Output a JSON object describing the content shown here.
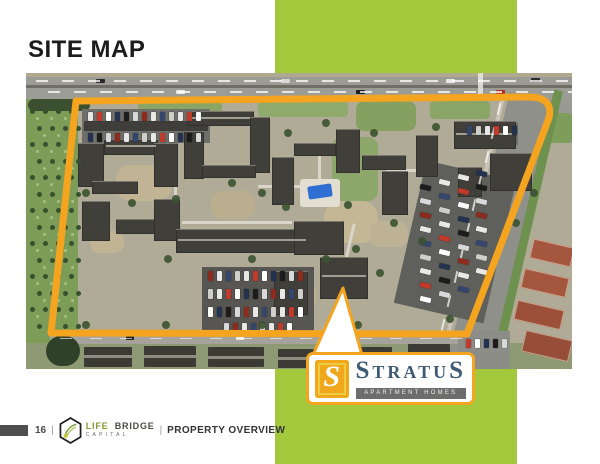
{
  "slide": {
    "title": "SITE MAP",
    "accent_green": "#a3c83c",
    "accent_orange": "#f4a41f"
  },
  "footer": {
    "page_number": "16",
    "divider": "|",
    "brand_word1": "LIFE",
    "brand_word2": "BRIDGE",
    "brand_sub": "CAPITAL",
    "section": "PROPERTY OVERVIEW"
  },
  "logo": {
    "tile_letter": "S",
    "name_first": "S",
    "name_mid": "TRATU",
    "name_last": "S",
    "subtitle": "APARTMENT HOMES",
    "name_color": "#3e5a74",
    "bar_color": "#6d6d6d",
    "tile_color": "#f0a71c"
  },
  "callout": {
    "tail_points": "43,8 62,75 13,75"
  },
  "map": {
    "boundary_path": "M50 28 L500 24 Q528 23 523 45 L441 261 L25 260 Z",
    "boundary_color": "#f4a41f",
    "car_palette": [
      "#e8e8e6",
      "#c23a2c",
      "#ffffff",
      "#23324f",
      "#1c1c1c",
      "#d6d8da",
      "#8e2b1f",
      "#e8e8e6",
      "#34466e",
      "#cfcfca"
    ],
    "rects": [
      {
        "x": 0,
        "y": 0,
        "w": 546,
        "h": 26,
        "c": "#9c9c97"
      },
      {
        "x": 0,
        "y": 0,
        "w": 546,
        "h": 4,
        "c": "#b0a88f"
      },
      {
        "x": 0,
        "y": 12,
        "w": 546,
        "h": 2.5,
        "c": "#6f6d66"
      },
      {
        "x": 452,
        "y": 0,
        "w": 5,
        "h": 26,
        "c": "#e6e6e2",
        "o": 0.85
      },
      {
        "x": 70,
        "y": 6,
        "w": 9,
        "h": 4,
        "c": "#2a2a2a",
        "br": 1
      },
      {
        "x": 150,
        "y": 17,
        "w": 9,
        "h": 4,
        "c": "#e8e8e6",
        "br": 1
      },
      {
        "x": 255,
        "y": 6,
        "w": 9,
        "h": 4,
        "c": "#d8d8d4",
        "br": 1
      },
      {
        "x": 330,
        "y": 17,
        "w": 9,
        "h": 4,
        "c": "#1f1f1f",
        "br": 1
      },
      {
        "x": 420,
        "y": 6,
        "w": 9,
        "h": 4,
        "c": "#e8e8e6",
        "br": 1
      },
      {
        "x": 470,
        "y": 17,
        "w": 9,
        "h": 4,
        "c": "#b02c20",
        "br": 1
      },
      {
        "x": 505,
        "y": 5,
        "w": 9,
        "h": 4,
        "c": "#2a2a2a",
        "br": 1
      },
      {
        "x": 0,
        "y": 26,
        "w": 52,
        "h": 244,
        "c": "#7d9c58"
      },
      {
        "x": 2,
        "y": 26,
        "w": 62,
        "h": 12,
        "c": "#3c4f30",
        "br": 6
      },
      {
        "x": 0,
        "y": 270,
        "w": 546,
        "h": 26,
        "c": "#8e9a74"
      },
      {
        "x": 508,
        "y": 26,
        "w": 38,
        "h": 44,
        "c": "#9a9a94"
      },
      {
        "x": 522,
        "y": 40,
        "w": 24,
        "h": 30,
        "c": "#7e9c5a",
        "br": 4
      },
      {
        "x": 452,
        "y": 20,
        "w": 44,
        "h": 276,
        "c": "#90908b",
        "rot": 13
      },
      {
        "x": 497,
        "y": 14,
        "w": 9,
        "h": 276,
        "c": "#6f9150",
        "rot": 13
      },
      {
        "x": 444,
        "y": 24,
        "w": 4,
        "h": 268,
        "c": "#cfccc0",
        "o": 0.8,
        "rot": 13
      },
      {
        "x": 112,
        "y": 28,
        "w": 84,
        "h": 14,
        "c": "#8ba566",
        "br": 4
      },
      {
        "x": 232,
        "y": 28,
        "w": 90,
        "h": 16,
        "c": "#90a96c",
        "br": 4
      },
      {
        "x": 330,
        "y": 28,
        "w": 60,
        "h": 30,
        "c": "#85a060",
        "br": 8
      },
      {
        "x": 404,
        "y": 28,
        "w": 60,
        "h": 18,
        "c": "#8ba566",
        "br": 4
      },
      {
        "x": 306,
        "y": 64,
        "w": 46,
        "h": 64,
        "c": "#8da66a",
        "br": 10
      },
      {
        "x": 90,
        "y": 92,
        "w": 56,
        "h": 36,
        "c": "#c0b494",
        "br": 14
      },
      {
        "x": 185,
        "y": 118,
        "w": 44,
        "h": 28,
        "c": "#bbae8e",
        "br": 12
      },
      {
        "x": 298,
        "y": 128,
        "w": 54,
        "h": 42,
        "c": "#c3b795",
        "br": 16
      },
      {
        "x": 246,
        "y": 208,
        "w": 44,
        "h": 32,
        "c": "#bdb192",
        "br": 12
      },
      {
        "x": 64,
        "y": 158,
        "w": 34,
        "h": 22,
        "c": "#c0b494",
        "br": 10
      },
      {
        "x": 344,
        "y": 148,
        "w": 38,
        "h": 26,
        "c": "#beb294",
        "br": 10
      },
      {
        "x": 148,
        "y": 60,
        "w": 3,
        "h": 70,
        "c": "#d9d5c8"
      },
      {
        "x": 232,
        "y": 112,
        "w": 60,
        "h": 3,
        "c": "#d9d5c8"
      },
      {
        "x": 292,
        "y": 76,
        "w": 3,
        "h": 54,
        "c": "#d9d5c8"
      },
      {
        "x": 156,
        "y": 148,
        "w": 110,
        "h": 3,
        "c": "#d9d5c8"
      },
      {
        "x": 320,
        "y": 150,
        "w": 3,
        "h": 60,
        "c": "#d9d5c8",
        "rot": 13
      },
      {
        "x": 360,
        "y": 96,
        "w": 40,
        "h": 3,
        "c": "#d9d5c8"
      },
      {
        "x": 56,
        "y": 36,
        "w": 128,
        "h": 34,
        "c": "#6e6e6a"
      },
      {
        "x": 58,
        "y": 48,
        "w": 124,
        "h": 10,
        "c": "#3f3e3a"
      },
      {
        "x": 176,
        "y": 194,
        "w": 112,
        "h": 66,
        "c": "#575652"
      },
      {
        "x": 383,
        "y": 96,
        "w": 92,
        "h": 146,
        "c": "#5f5f5b",
        "rot": 13
      },
      {
        "x": 438,
        "y": 50,
        "w": 54,
        "h": 22,
        "c": "#6e6e6a"
      },
      {
        "x": 52,
        "y": 70,
        "w": 26,
        "h": 44,
        "c": "#403f3a",
        "cls": "bld"
      },
      {
        "x": 78,
        "y": 66,
        "w": 54,
        "h": 16,
        "c": "#403f3a",
        "cls": "bld"
      },
      {
        "x": 128,
        "y": 70,
        "w": 24,
        "h": 44,
        "c": "#403f3a",
        "cls": "bld"
      },
      {
        "x": 66,
        "y": 108,
        "w": 46,
        "h": 13,
        "c": "#403f3a",
        "cls": "bld"
      },
      {
        "x": 56,
        "y": 128,
        "w": 28,
        "h": 40,
        "c": "#403f3a",
        "cls": "bld"
      },
      {
        "x": 90,
        "y": 146,
        "w": 44,
        "h": 15,
        "c": "#403f3a",
        "cls": "bld"
      },
      {
        "x": 128,
        "y": 126,
        "w": 26,
        "h": 42,
        "c": "#403f3a",
        "cls": "bld"
      },
      {
        "x": 162,
        "y": 38,
        "w": 66,
        "h": 15,
        "c": "#403f3a",
        "cls": "bld"
      },
      {
        "x": 158,
        "y": 58,
        "w": 20,
        "h": 48,
        "c": "#403f3a",
        "cls": "bld"
      },
      {
        "x": 224,
        "y": 44,
        "w": 20,
        "h": 56,
        "c": "#403f3a",
        "cls": "bld"
      },
      {
        "x": 176,
        "y": 92,
        "w": 54,
        "h": 13,
        "c": "#403f3a",
        "cls": "bld"
      },
      {
        "x": 150,
        "y": 156,
        "w": 132,
        "h": 24,
        "c": "#403f3a",
        "cls": "bld"
      },
      {
        "x": 246,
        "y": 84,
        "w": 22,
        "h": 48,
        "c": "#403f3a",
        "cls": "bld"
      },
      {
        "x": 268,
        "y": 70,
        "w": 42,
        "h": 13,
        "c": "#403f3a",
        "cls": "bld"
      },
      {
        "x": 310,
        "y": 56,
        "w": 24,
        "h": 44,
        "c": "#403f3a",
        "cls": "bld"
      },
      {
        "x": 336,
        "y": 82,
        "w": 44,
        "h": 15,
        "c": "#403f3a",
        "cls": "bld"
      },
      {
        "x": 356,
        "y": 98,
        "w": 26,
        "h": 44,
        "c": "#403f3a",
        "cls": "bld"
      },
      {
        "x": 390,
        "y": 62,
        "w": 22,
        "h": 42,
        "c": "#403f3a",
        "cls": "bld"
      },
      {
        "x": 428,
        "y": 48,
        "w": 62,
        "h": 28,
        "c": "#403f3a",
        "cls": "bld"
      },
      {
        "x": 464,
        "y": 80,
        "w": 42,
        "h": 38,
        "c": "#403f3a",
        "cls": "bld"
      },
      {
        "x": 432,
        "y": 94,
        "w": 24,
        "h": 30,
        "c": "#403f3a",
        "cls": "bld"
      },
      {
        "x": 268,
        "y": 148,
        "w": 50,
        "h": 34,
        "c": "#403f3a",
        "cls": "bld"
      },
      {
        "x": 294,
        "y": 184,
        "w": 48,
        "h": 42,
        "c": "#403f3a",
        "cls": "bld"
      },
      {
        "x": 248,
        "y": 198,
        "w": 34,
        "h": 44,
        "c": "#403f3a",
        "cls": "bld"
      },
      {
        "x": 80,
        "y": 72,
        "w": 50,
        "h": 2,
        "c": "#b9b6a9",
        "o": 0.8
      },
      {
        "x": 164,
        "y": 44,
        "w": 60,
        "h": 2,
        "c": "#b9b6a9",
        "o": 0.8
      },
      {
        "x": 152,
        "y": 166,
        "w": 128,
        "h": 2,
        "c": "#b9b6a9",
        "o": 0.8
      },
      {
        "x": 296,
        "y": 202,
        "w": 44,
        "h": 2,
        "c": "#b9b6a9",
        "o": 0.8
      },
      {
        "x": 430,
        "y": 60,
        "w": 58,
        "h": 2,
        "c": "#b9b6a9",
        "o": 0.8
      },
      {
        "x": 24,
        "y": 261,
        "w": 436,
        "h": 10,
        "c": "#a5a39c"
      },
      {
        "x": 58,
        "y": 274,
        "w": 48,
        "h": 20,
        "c": "#3b3a35",
        "br": 1
      },
      {
        "x": 118,
        "y": 273,
        "w": 52,
        "h": 21,
        "c": "#3b3a35",
        "br": 1
      },
      {
        "x": 182,
        "y": 274,
        "w": 56,
        "h": 20,
        "c": "#3b3a35",
        "br": 1
      },
      {
        "x": 252,
        "y": 276,
        "w": 52,
        "h": 19,
        "c": "#3b3a35",
        "br": 1
      },
      {
        "x": 318,
        "y": 274,
        "w": 48,
        "h": 21,
        "c": "#3b3a35",
        "br": 1
      },
      {
        "x": 382,
        "y": 271,
        "w": 42,
        "h": 23,
        "c": "#3b3a35",
        "br": 1
      },
      {
        "x": 58,
        "y": 282,
        "w": 48,
        "h": 3,
        "c": "#8f8b80"
      },
      {
        "x": 118,
        "y": 282,
        "w": 52,
        "h": 3,
        "c": "#8f8b80"
      },
      {
        "x": 182,
        "y": 283,
        "w": 56,
        "h": 3,
        "c": "#8f8b80"
      },
      {
        "x": 252,
        "y": 284,
        "w": 52,
        "h": 3,
        "c": "#8f8b80"
      },
      {
        "x": 318,
        "y": 283,
        "w": 48,
        "h": 3,
        "c": "#8f8b80"
      },
      {
        "x": 20,
        "y": 263,
        "w": 34,
        "h": 30,
        "c": "#2f4129",
        "br": 15
      },
      {
        "x": 432,
        "y": 258,
        "w": 52,
        "h": 38,
        "c": "#8d8d88"
      },
      {
        "x": 505,
        "y": 170,
        "w": 42,
        "h": 20,
        "c": "#a5563e",
        "rot": 13,
        "cls": "red"
      },
      {
        "x": 496,
        "y": 200,
        "w": 46,
        "h": 20,
        "c": "#a5563e",
        "rot": 13,
        "cls": "red"
      },
      {
        "x": 489,
        "y": 232,
        "w": 48,
        "h": 20,
        "c": "#9c5039",
        "rot": 13,
        "cls": "red"
      },
      {
        "x": 497,
        "y": 262,
        "w": 48,
        "h": 22,
        "c": "#964e38",
        "rot": 13,
        "cls": "red"
      },
      {
        "x": 100,
        "y": 263,
        "w": 8,
        "h": 4,
        "c": "#222222",
        "br": 1
      },
      {
        "x": 210,
        "y": 263,
        "w": 8,
        "h": 4,
        "c": "#e8e8e6",
        "br": 1
      },
      {
        "x": 300,
        "y": 263,
        "w": 8,
        "h": 4,
        "c": "#333333",
        "br": 1
      },
      {
        "x": 274,
        "y": 106,
        "w": 40,
        "h": 28,
        "c": "#e2ded2",
        "br": 3
      },
      {
        "x": 282,
        "y": 112,
        "w": 24,
        "h": 13,
        "c": "#2f6ed2",
        "rot": -8,
        "br": 2
      }
    ],
    "dash_rows": [
      {
        "x": 10,
        "y": 7,
        "n": 21,
        "dx": 26,
        "dy": 0,
        "w": 12,
        "h": 1.6,
        "c": "#ffffff",
        "o": 0.75
      },
      {
        "x": 22,
        "y": 18,
        "n": 21,
        "dx": 26,
        "dy": 0,
        "w": 12,
        "h": 1.6,
        "c": "#ffffff",
        "o": 0.75
      },
      {
        "x": 34,
        "y": 265,
        "n": 14,
        "dx": 30,
        "dy": 0,
        "w": 12,
        "h": 1.4,
        "c": "#ffffff",
        "o": 0.6
      },
      {
        "x": 472,
        "y": 30,
        "n": 10,
        "dx": -6.2,
        "dy": 24,
        "w": 2.4,
        "h": 12,
        "c": "#ffffff",
        "o": 0.7,
        "rot": 13
      }
    ],
    "car_rows": [
      {
        "x": 62,
        "y": 39,
        "n": 13,
        "dx": 9,
        "dy": 0,
        "cw": 5,
        "ch": 9
      },
      {
        "x": 62,
        "y": 60,
        "n": 13,
        "dx": 9,
        "dy": 0,
        "cw": 5,
        "ch": 9
      },
      {
        "x": 182,
        "y": 198,
        "n": 11,
        "dx": 9,
        "dy": 0,
        "cw": 5,
        "ch": 10
      },
      {
        "x": 182,
        "y": 216,
        "n": 11,
        "dx": 9,
        "dy": 0,
        "cw": 5,
        "ch": 10
      },
      {
        "x": 182,
        "y": 234,
        "n": 11,
        "dx": 9,
        "dy": 0,
        "cw": 5,
        "ch": 10
      },
      {
        "x": 198,
        "y": 250,
        "n": 8,
        "dx": 9,
        "dy": 0,
        "cw": 5,
        "ch": 9
      },
      {
        "x": 441,
        "y": 53,
        "n": 6,
        "dx": 9,
        "dy": 0,
        "cw": 5,
        "ch": 9
      },
      {
        "x": 440,
        "y": 266,
        "n": 5,
        "dx": 9,
        "dy": 0,
        "cw": 5,
        "ch": 9
      },
      {
        "x": 394,
        "y": 112,
        "n": 9,
        "dx": 0,
        "dy": 14,
        "cw": 11,
        "ch": 5,
        "rot": 13
      },
      {
        "x": 413,
        "y": 107,
        "n": 9,
        "dx": 0,
        "dy": 14,
        "cw": 11,
        "ch": 5,
        "rot": 13
      },
      {
        "x": 432,
        "y": 102,
        "n": 9,
        "dx": 0,
        "dy": 14,
        "cw": 11,
        "ch": 5,
        "rot": 13
      },
      {
        "x": 450,
        "y": 98,
        "n": 8,
        "dx": 0,
        "dy": 14,
        "cw": 11,
        "ch": 5,
        "rot": 13
      }
    ],
    "tree_grids": [
      {
        "x": 4,
        "y": 36,
        "cols": 4,
        "rows": 14,
        "dx": 13,
        "dy": 16.5,
        "r": 2.5,
        "c": "#35512d"
      },
      {
        "x": 10,
        "y": 44,
        "cols": 3,
        "rows": 13,
        "dx": 14,
        "dy": 16.5,
        "r": 1.5,
        "c": "#a7bf82"
      }
    ],
    "trees": [
      [
        150,
        126
      ],
      [
        236,
        120
      ],
      [
        300,
        50
      ],
      [
        322,
        132
      ],
      [
        260,
        134
      ],
      [
        106,
        130
      ],
      [
        142,
        186
      ],
      [
        226,
        186
      ],
      [
        330,
        176
      ],
      [
        368,
        150
      ],
      [
        396,
        168
      ],
      [
        262,
        60
      ],
      [
        206,
        110
      ],
      [
        60,
        120
      ],
      [
        348,
        60
      ],
      [
        410,
        54
      ],
      [
        300,
        186
      ],
      [
        354,
        200
      ],
      [
        140,
        252
      ],
      [
        236,
        252
      ],
      [
        332,
        252
      ],
      [
        60,
        252
      ],
      [
        424,
        246
      ],
      [
        490,
        150
      ],
      [
        508,
        120
      ]
    ]
  }
}
